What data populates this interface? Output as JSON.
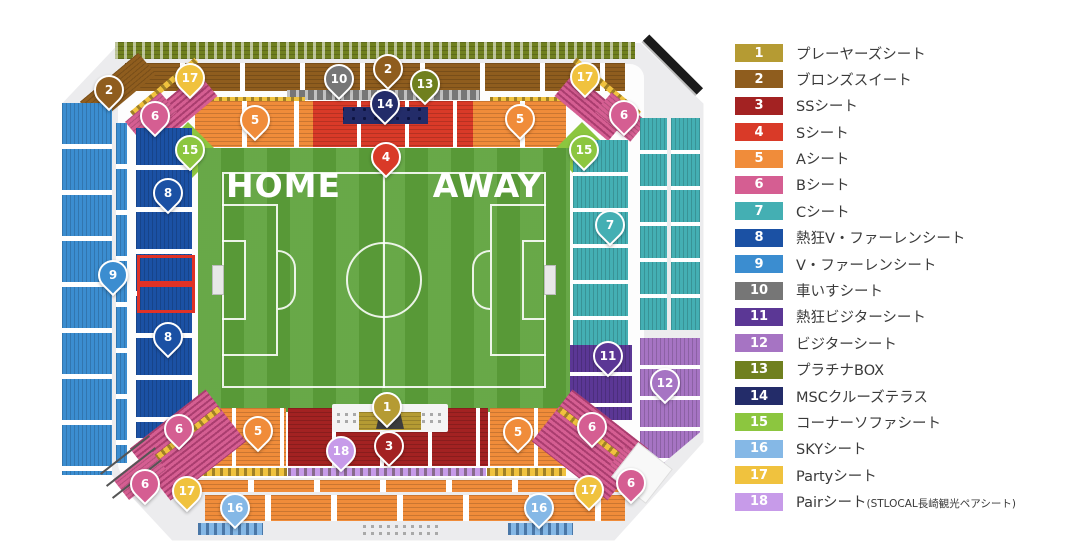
{
  "map": {
    "home_label": "HOME",
    "away_label": "AWAY",
    "markers": [
      {
        "n": 1,
        "x": 325,
        "y": 367
      },
      {
        "n": 2,
        "x": 47,
        "y": 50
      },
      {
        "n": 2,
        "x": 326,
        "y": 29
      },
      {
        "n": 3,
        "x": 327,
        "y": 406
      },
      {
        "n": 4,
        "x": 324,
        "y": 117
      },
      {
        "n": 5,
        "x": 193,
        "y": 80
      },
      {
        "n": 5,
        "x": 458,
        "y": 79
      },
      {
        "n": 5,
        "x": 196,
        "y": 391
      },
      {
        "n": 5,
        "x": 456,
        "y": 392
      },
      {
        "n": 6,
        "x": 93,
        "y": 76
      },
      {
        "n": 6,
        "x": 562,
        "y": 75
      },
      {
        "n": 6,
        "x": 117,
        "y": 389
      },
      {
        "n": 6,
        "x": 83,
        "y": 444
      },
      {
        "n": 6,
        "x": 530,
        "y": 387
      },
      {
        "n": 6,
        "x": 569,
        "y": 443
      },
      {
        "n": 7,
        "x": 548,
        "y": 185
      },
      {
        "n": 8,
        "x": 106,
        "y": 153
      },
      {
        "n": 8,
        "x": 106,
        "y": 297
      },
      {
        "n": 9,
        "x": 51,
        "y": 235
      },
      {
        "n": 10,
        "x": 277,
        "y": 39
      },
      {
        "n": 11,
        "x": 546,
        "y": 316
      },
      {
        "n": 12,
        "x": 603,
        "y": 343
      },
      {
        "n": 13,
        "x": 363,
        "y": 44
      },
      {
        "n": 14,
        "x": 323,
        "y": 64
      },
      {
        "n": 15,
        "x": 128,
        "y": 110
      },
      {
        "n": 15,
        "x": 522,
        "y": 110
      },
      {
        "n": 16,
        "x": 173,
        "y": 468
      },
      {
        "n": 16,
        "x": 477,
        "y": 468
      },
      {
        "n": 17,
        "x": 128,
        "y": 38
      },
      {
        "n": 17,
        "x": 523,
        "y": 37
      },
      {
        "n": 17,
        "x": 125,
        "y": 451
      },
      {
        "n": 17,
        "x": 527,
        "y": 450
      },
      {
        "n": 18,
        "x": 279,
        "y": 411
      }
    ]
  },
  "legend": {
    "items": [
      {
        "num": "1",
        "label": "プレーヤーズシート",
        "color": "#B59B33"
      },
      {
        "num": "2",
        "label": "ブロンズスイート",
        "color": "#8F5D1E"
      },
      {
        "num": "3",
        "label": "SSシート",
        "color": "#A32222"
      },
      {
        "num": "4",
        "label": "Sシート",
        "color": "#D93A28"
      },
      {
        "num": "5",
        "label": "Aシート",
        "color": "#F08C3A"
      },
      {
        "num": "6",
        "label": "Bシート",
        "color": "#D55E92"
      },
      {
        "num": "7",
        "label": "Cシート",
        "color": "#44AFB3"
      },
      {
        "num": "8",
        "label": "熱狂V・ファーレンシート",
        "color": "#1B51A4"
      },
      {
        "num": "9",
        "label": "V・ファーレンシート",
        "color": "#3B8DD0"
      },
      {
        "num": "10",
        "label": "車いすシート",
        "color": "#767676"
      },
      {
        "num": "11",
        "label": "熱狂ビジターシート",
        "color": "#5B3795"
      },
      {
        "num": "12",
        "label": "ビジターシート",
        "color": "#A674C3"
      },
      {
        "num": "13",
        "label": "プラチナBOX",
        "color": "#70801F"
      },
      {
        "num": "14",
        "label": "MSCクルーズテラス",
        "color": "#232C69"
      },
      {
        "num": "15",
        "label": "コーナーソファシート",
        "color": "#8CC63F"
      },
      {
        "num": "16",
        "label": "SKYシート",
        "color": "#85B8E6"
      },
      {
        "num": "17",
        "label": "Partyシート",
        "color": "#F0C23E"
      },
      {
        "num": "18",
        "label": "Pairシート",
        "suffix": "(STLOCAL長崎観光ペアシート)",
        "color": "#C79BE9"
      }
    ]
  }
}
